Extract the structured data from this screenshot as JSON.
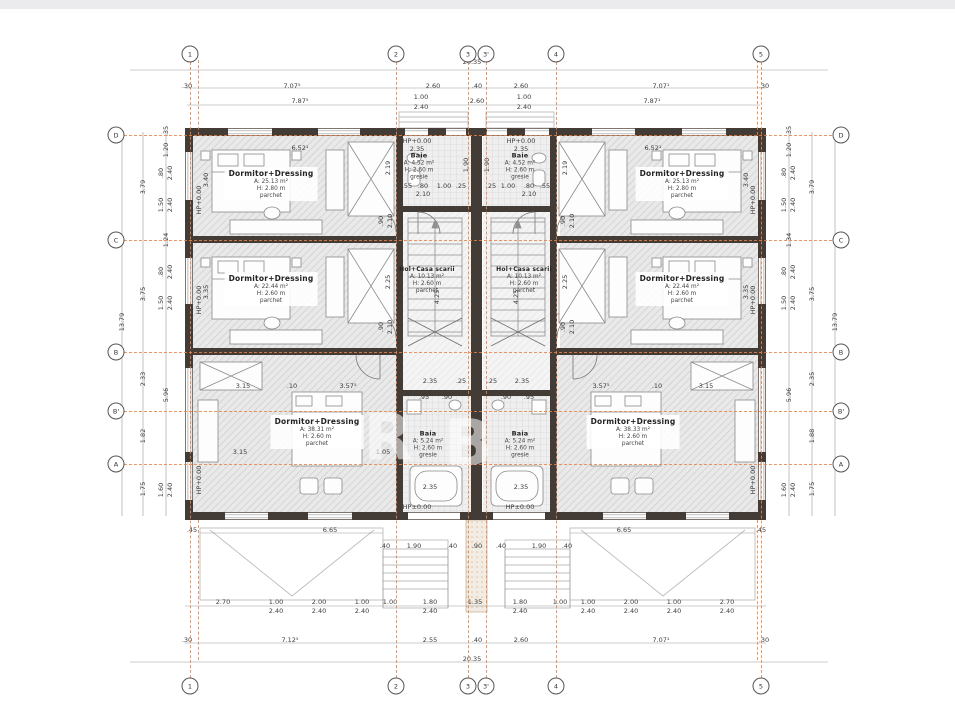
{
  "plan_title": "Etaj - plan duplex",
  "colors": {
    "axis_orange": "#e8834a",
    "wall": "#433b35",
    "dim_text": "#3b3b3b",
    "hatch": "#c9c9c9"
  },
  "axes": {
    "vertical": [
      {
        "label": "1",
        "x": 190
      },
      {
        "label": "2",
        "x": 396
      },
      {
        "label": "3",
        "x": 468
      },
      {
        "label": "3'",
        "x": 486
      },
      {
        "label": "4",
        "x": 556
      },
      {
        "label": "5",
        "x": 761
      }
    ],
    "horizontal": [
      {
        "label": "D",
        "y": 135
      },
      {
        "label": "C",
        "y": 240
      },
      {
        "label": "B",
        "y": 352
      },
      {
        "label": "B'",
        "y": 411
      },
      {
        "label": "A",
        "y": 464
      }
    ]
  },
  "rooms": [
    {
      "name": "Dormitor+Dressing",
      "area": "A: 25.13 m²",
      "height": "H: 2.80 m",
      "finish": "parchet"
    },
    {
      "name": "Dormitor+Dressing",
      "area": "A: 22.44 m²",
      "height": "H: 2.60 m",
      "finish": "parchet"
    },
    {
      "name": "Dormitor+Dressing",
      "area": "A: 38.31 m²",
      "height": "H: 2.60 m",
      "finish": "parchet"
    },
    {
      "name": "Dormitor+Dressing",
      "area": "A: 25.13 m²",
      "height": "H: 2.80 m",
      "finish": "parchet"
    },
    {
      "name": "Dormitor+Dressing",
      "area": "A: 22.44 m²",
      "height": "H: 2.60 m",
      "finish": "parchet"
    },
    {
      "name": "Dormitor+Dressing",
      "area": "A: 38.33 m²",
      "height": "H: 2.60 m",
      "finish": "parchet"
    },
    {
      "name": "Baie",
      "area": "A: 4.52 m²",
      "height": "H: 2.60 m",
      "finish": "gresie"
    },
    {
      "name": "Baie",
      "area": "A: 4.52 m²",
      "height": "H: 2.60 m",
      "finish": "gresie"
    },
    {
      "name": "Hol+Casa scarii",
      "area": "A: 10.13 m²",
      "height": "H: 2.60 m",
      "finish": "parchet"
    },
    {
      "name": "Hol+Casa scarii",
      "area": "A: 10.13 m²",
      "height": "H: 2.60 m",
      "finish": "parchet"
    },
    {
      "name": "Baia",
      "area": "A: 5.24 m²",
      "height": "H: 2.60 m",
      "finish": "gresie"
    },
    {
      "name": "Baia",
      "area": "A: 5.24 m²",
      "height": "H: 2.60 m",
      "finish": "gresie"
    }
  ],
  "watermark": {
    "letters": [
      "R",
      "B"
    ]
  },
  "dimensions": [
    [
      "20.35",
      472,
      62,
      0
    ],
    [
      ".30",
      187,
      86,
      0
    ],
    [
      "7.07⁵",
      292,
      86,
      0
    ],
    [
      "2.60",
      433,
      86,
      0
    ],
    [
      ".40",
      477,
      86,
      0
    ],
    [
      "2.60",
      521,
      86,
      0
    ],
    [
      "7.07¹",
      661,
      86,
      0
    ],
    [
      ".30",
      764,
      86,
      0
    ],
    [
      "7.87⁵",
      300,
      101,
      0
    ],
    [
      "1.00",
      421,
      97,
      0
    ],
    [
      "2.40",
      421,
      107,
      0
    ],
    [
      "2.60",
      477,
      101,
      0
    ],
    [
      "1.00",
      524,
      97,
      0
    ],
    [
      "2.40",
      524,
      107,
      0
    ],
    [
      "7.87¹",
      652,
      101,
      0
    ],
    [
      "2.70",
      223,
      602,
      0
    ],
    [
      "1.00",
      276,
      602,
      0
    ],
    [
      "2.00",
      319,
      602,
      0
    ],
    [
      "1.00",
      362,
      602,
      0
    ],
    [
      "1.00",
      390,
      602,
      0
    ],
    [
      "1.80",
      430,
      602,
      0
    ],
    [
      "1.35",
      475,
      602,
      0
    ],
    [
      "1.80",
      520,
      602,
      0
    ],
    [
      "1.00",
      560,
      602,
      0
    ],
    [
      "1.00",
      588,
      602,
      0
    ],
    [
      "2.00",
      631,
      602,
      0
    ],
    [
      "1.00",
      674,
      602,
      0
    ],
    [
      "2.70",
      727,
      602,
      0
    ],
    [
      "2.40",
      276,
      611,
      0
    ],
    [
      "2.40",
      319,
      611,
      0
    ],
    [
      "2.40",
      362,
      611,
      0
    ],
    [
      "2.40",
      430,
      611,
      0
    ],
    [
      "2.40",
      520,
      611,
      0
    ],
    [
      "2.40",
      588,
      611,
      0
    ],
    [
      "2.40",
      631,
      611,
      0
    ],
    [
      "2.40",
      674,
      611,
      0
    ],
    [
      "2.40",
      727,
      611,
      0
    ],
    [
      ".30",
      187,
      640,
      0
    ],
    [
      "7.12⁵",
      290,
      640,
      0
    ],
    [
      "2.55",
      430,
      640,
      0
    ],
    [
      ".40",
      477,
      640,
      0
    ],
    [
      "2.60",
      521,
      640,
      0
    ],
    [
      "7.07¹",
      661,
      640,
      0
    ],
    [
      ".30",
      764,
      640,
      0
    ],
    [
      "20.35",
      472,
      659,
      0
    ],
    [
      "13.79",
      122,
      322,
      1
    ],
    [
      "3.79",
      143,
      187,
      1
    ],
    [
      "3.75",
      143,
      294,
      1
    ],
    [
      "2.33",
      143,
      379,
      1
    ],
    [
      "1.82",
      143,
      436,
      1
    ],
    [
      "1.75",
      143,
      489,
      1
    ],
    [
      ".35",
      166,
      131,
      1
    ],
    [
      "1.20",
      166,
      150,
      1
    ],
    [
      ".80",
      161,
      173,
      1
    ],
    [
      "2.40",
      170,
      173,
      1
    ],
    [
      "1.50",
      161,
      205,
      1
    ],
    [
      "2.40",
      170,
      205,
      1
    ],
    [
      "1.24",
      166,
      240,
      1
    ],
    [
      ".80",
      161,
      272,
      1
    ],
    [
      "2.40",
      170,
      272,
      1
    ],
    [
      "1.50",
      161,
      303,
      1
    ],
    [
      "2.40",
      170,
      303,
      1
    ],
    [
      "5.96",
      166,
      395,
      1
    ],
    [
      "1.60",
      161,
      490,
      1
    ],
    [
      "2.40",
      170,
      490,
      1
    ],
    [
      "13.79",
      835,
      322,
      1
    ],
    [
      "3.79",
      812,
      187,
      1
    ],
    [
      "3.75",
      812,
      294,
      1
    ],
    [
      "2.35",
      812,
      379,
      1
    ],
    [
      "1.88",
      812,
      436,
      1
    ],
    [
      "1.75",
      812,
      489,
      1
    ],
    [
      ".35",
      789,
      131,
      1
    ],
    [
      "1.20",
      789,
      150,
      1
    ],
    [
      ".80",
      784,
      173,
      1
    ],
    [
      "2.40",
      793,
      173,
      1
    ],
    [
      "1.50",
      784,
      205,
      1
    ],
    [
      "2.40",
      793,
      205,
      1
    ],
    [
      "1.34",
      789,
      240,
      1
    ],
    [
      ".80",
      784,
      272,
      1
    ],
    [
      "2.40",
      793,
      272,
      1
    ],
    [
      "1.50",
      784,
      303,
      1
    ],
    [
      "2.40",
      793,
      303,
      1
    ],
    [
      "5.96",
      789,
      395,
      1
    ],
    [
      "1.60",
      784,
      490,
      1
    ],
    [
      "2.40",
      793,
      490,
      1
    ],
    [
      "6.52¹",
      300,
      148,
      0
    ],
    [
      "6.52¹",
      653,
      148,
      0
    ],
    [
      "HP+0.00",
      199,
      200,
      1
    ],
    [
      "HP+0.00",
      199,
      300,
      1
    ],
    [
      "HP+0.00",
      199,
      480,
      1
    ],
    [
      "HP+0.00",
      753,
      200,
      1
    ],
    [
      "HP+0.00",
      753,
      300,
      1
    ],
    [
      "HP+0.00",
      753,
      480,
      1
    ],
    [
      "3.40",
      206,
      180,
      1
    ],
    [
      "3.35",
      206,
      292,
      1
    ],
    [
      "3.40",
      746,
      180,
      1
    ],
    [
      "3.35",
      746,
      292,
      1
    ],
    [
      "2.19",
      388,
      168,
      1
    ],
    [
      "2.25",
      388,
      282,
      1
    ],
    [
      "2.19",
      565,
      168,
      1
    ],
    [
      "2.25",
      565,
      282,
      1
    ],
    [
      ".90",
      381,
      221,
      1
    ],
    [
      "2.10",
      390,
      221,
      1
    ],
    [
      ".90",
      381,
      327,
      1
    ],
    [
      "2.10",
      390,
      327,
      1
    ],
    [
      ".90",
      563,
      221,
      1
    ],
    [
      "2.10",
      572,
      221,
      1
    ],
    [
      ".90",
      563,
      327,
      1
    ],
    [
      "2.10",
      572,
      327,
      1
    ],
    [
      "HP+0.00",
      417,
      141,
      0
    ],
    [
      "2.35",
      417,
      149,
      0
    ],
    [
      "HP+0.00",
      521,
      141,
      0
    ],
    [
      "2.35",
      521,
      149,
      0
    ],
    [
      ".55",
      407,
      186,
      0
    ],
    [
      ".80",
      423,
      186,
      0
    ],
    [
      "1.00",
      444,
      186,
      0
    ],
    [
      ".25",
      461,
      186,
      0
    ],
    [
      "2.10",
      423,
      194,
      0
    ],
    [
      ".25",
      491,
      186,
      0
    ],
    [
      "1.00",
      508,
      186,
      0
    ],
    [
      ".80",
      529,
      186,
      0
    ],
    [
      ".55",
      545,
      186,
      0
    ],
    [
      "2.10",
      529,
      194,
      0
    ],
    [
      "1.90",
      466,
      165,
      1
    ],
    [
      "1.90",
      487,
      165,
      1
    ],
    [
      "6.79",
      399,
      297,
      1
    ],
    [
      "4.25",
      437,
      297,
      1
    ],
    [
      "4.25",
      516,
      297,
      1
    ],
    [
      "6.79",
      554,
      297,
      1
    ],
    [
      "2.35",
      430,
      381,
      0
    ],
    [
      ".25",
      461,
      381,
      0
    ],
    [
      ".25",
      492,
      381,
      0
    ],
    [
      "2.35",
      522,
      381,
      0
    ],
    [
      ".95",
      424,
      397,
      0
    ],
    [
      ".90",
      447,
      397,
      0
    ],
    [
      ".90",
      506,
      397,
      0
    ],
    [
      ".95",
      529,
      397,
      0
    ],
    [
      "3.15",
      243,
      386,
      0
    ],
    [
      ".10",
      292,
      386,
      0
    ],
    [
      "3.57⁵",
      348,
      386,
      0
    ],
    [
      "3.57⁵",
      601,
      386,
      0
    ],
    [
      ".10",
      657,
      386,
      0
    ],
    [
      "3.15",
      706,
      386,
      0
    ],
    [
      "3.15",
      240,
      452,
      0
    ],
    [
      "1.05",
      383,
      452,
      0
    ],
    [
      "2.60",
      312,
      428,
      1
    ],
    [
      "2.60",
      641,
      428,
      1
    ],
    [
      "2.35",
      430,
      487,
      0
    ],
    [
      "2.35",
      521,
      487,
      0
    ],
    [
      "HP±0.00",
      417,
      507,
      0
    ],
    [
      "HP±0.00",
      520,
      507,
      0
    ],
    [
      ".40",
      385,
      546,
      0
    ],
    [
      "1.90",
      414,
      546,
      0
    ],
    [
      ".40",
      452,
      546,
      0
    ],
    [
      ".90",
      477,
      546,
      0
    ],
    [
      ".40",
      501,
      546,
      0
    ],
    [
      "1.90",
      539,
      546,
      0
    ],
    [
      ".40",
      567,
      546,
      0
    ],
    [
      ".45",
      192,
      530,
      0
    ],
    [
      "6.65",
      330,
      530,
      0
    ],
    [
      "6.65",
      624,
      530,
      0
    ],
    [
      ".45",
      761,
      530,
      0
    ]
  ]
}
